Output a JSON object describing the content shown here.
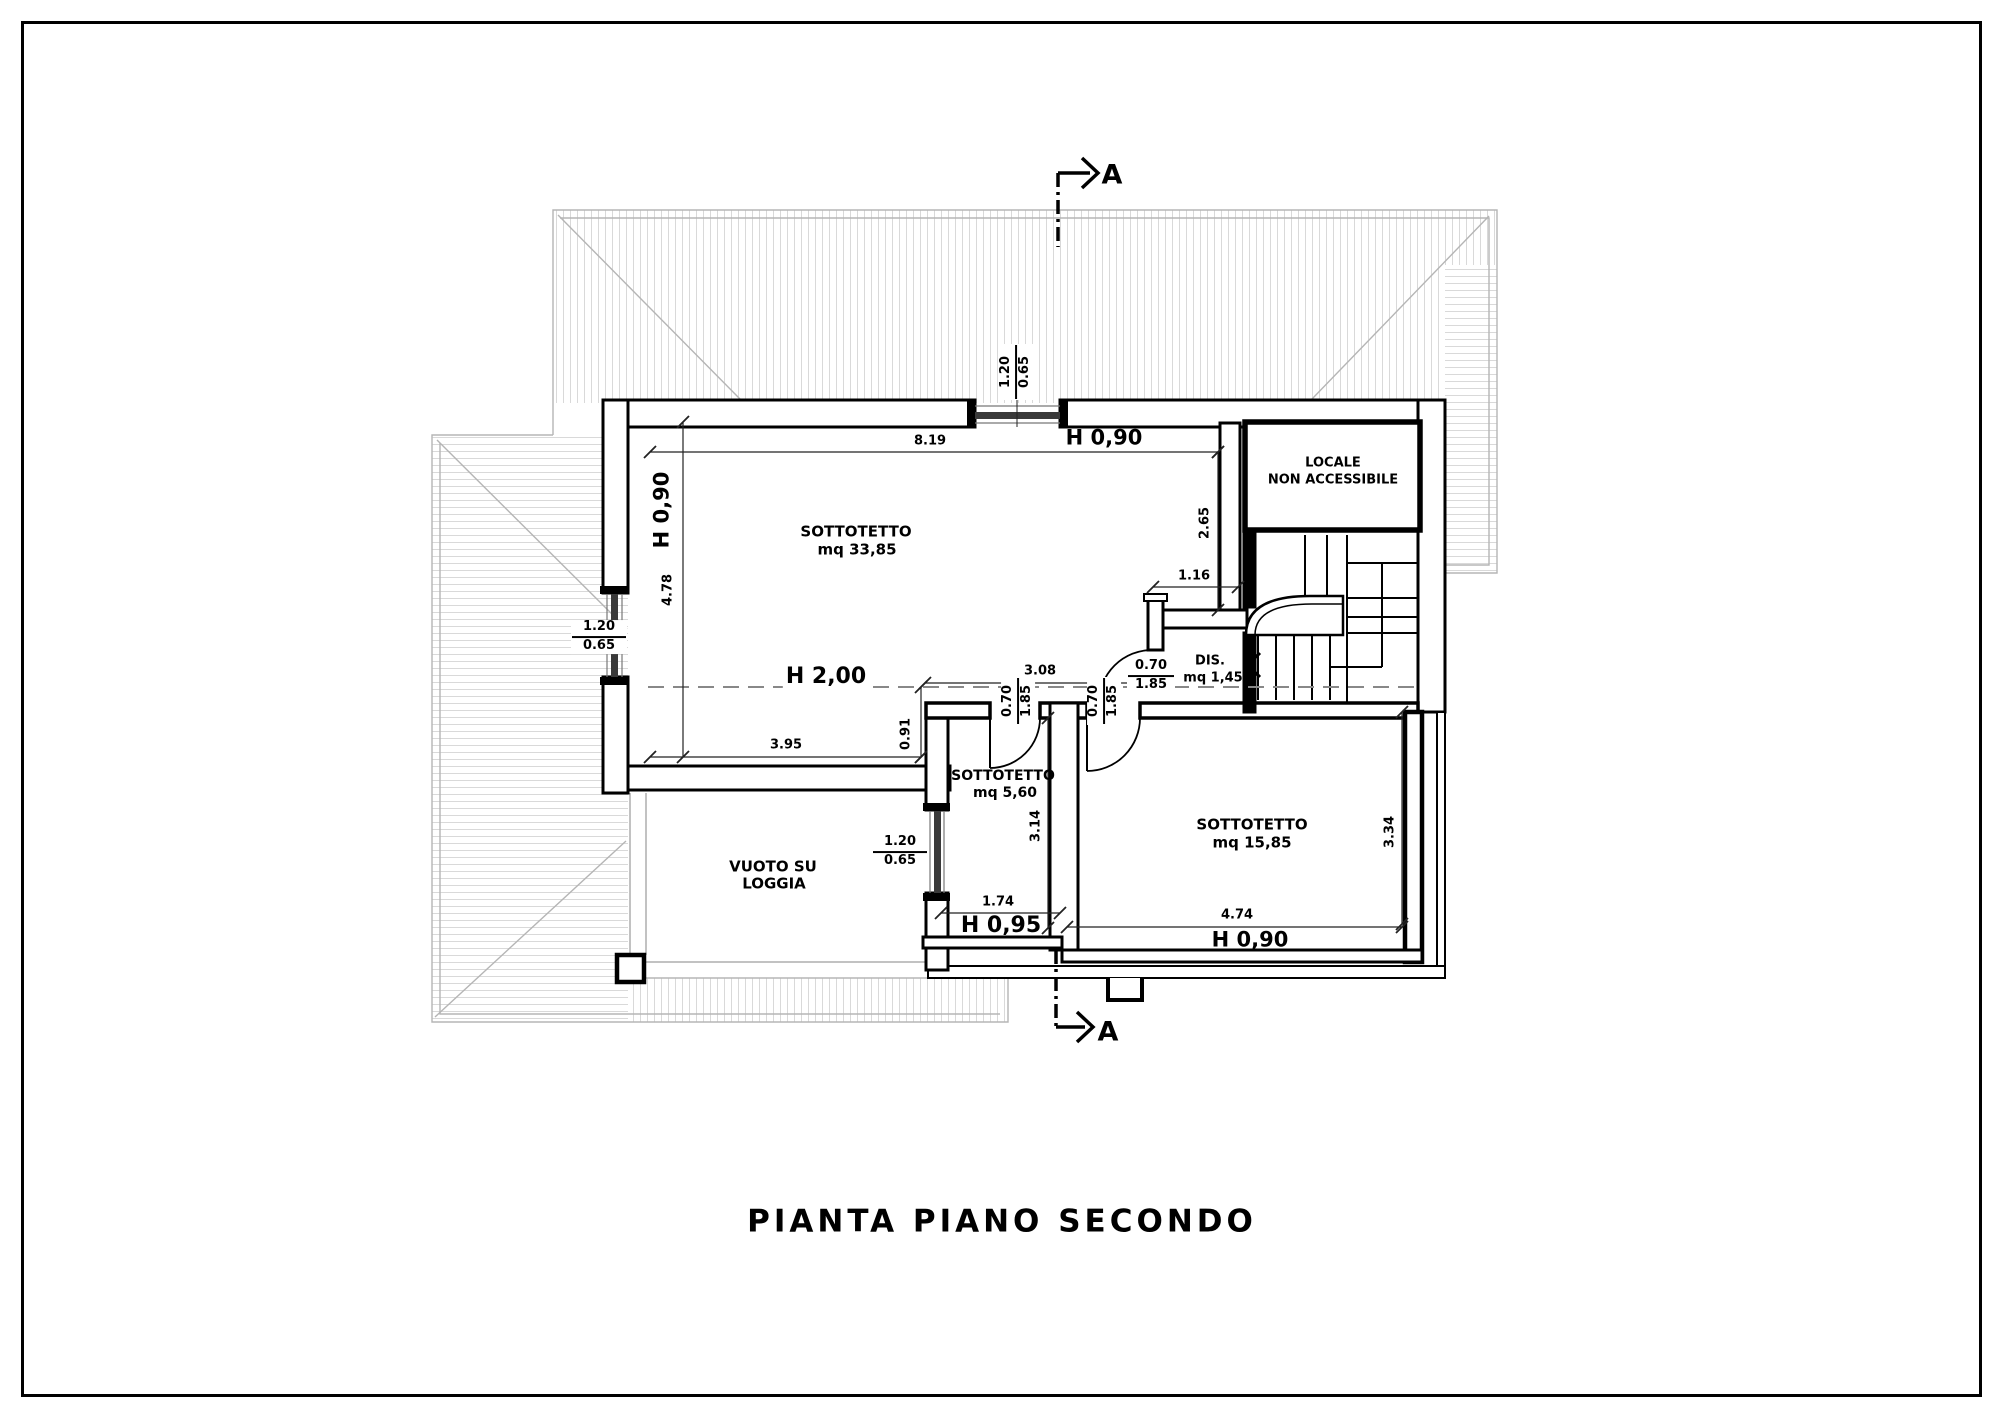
{
  "page": {
    "title": "PIANTA PIANO SECONDO"
  },
  "section": {
    "label": "A"
  },
  "rooms": {
    "main": {
      "name": "SOTTOTETTO",
      "area": "mq 33,85"
    },
    "small": {
      "name": "SOTTOTETTO",
      "area": "mq 5,60"
    },
    "right": {
      "name": "SOTTOTETTO",
      "area": "mq 15,85"
    },
    "dis": {
      "name": "DIS.",
      "area": "mq 1,45"
    },
    "locale": {
      "line1": "LOCALE",
      "line2": "NON ACCESSIBILE"
    },
    "loggia": {
      "line1": "VUOTO SU",
      "line2": "LOGGIA"
    }
  },
  "heights": {
    "top": "H 0,90",
    "left": "H 0,90",
    "mid": "H 2,00",
    "small": "H 0,95",
    "bottom": "H 0,90"
  },
  "dims": {
    "top_width": "8.19",
    "left_height": "4.78",
    "right_height": "2.65",
    "niche": "1.16",
    "mid_width": "3.08",
    "step": "0.91",
    "bottom_left_width": "3.95",
    "small_room_height": "3.14",
    "small_room_width": "1.74",
    "right_room_width": "4.74",
    "right_room_height": "3.34"
  },
  "window": {
    "width": "1.20",
    "height": "0.65"
  },
  "door": {
    "width": "0.70",
    "height": "1.85"
  },
  "colors": {
    "wall": "#000000",
    "roof_outline": "#b5b5b5",
    "roof_hatch": "#d9d9d9",
    "section_dash": "#888888"
  }
}
